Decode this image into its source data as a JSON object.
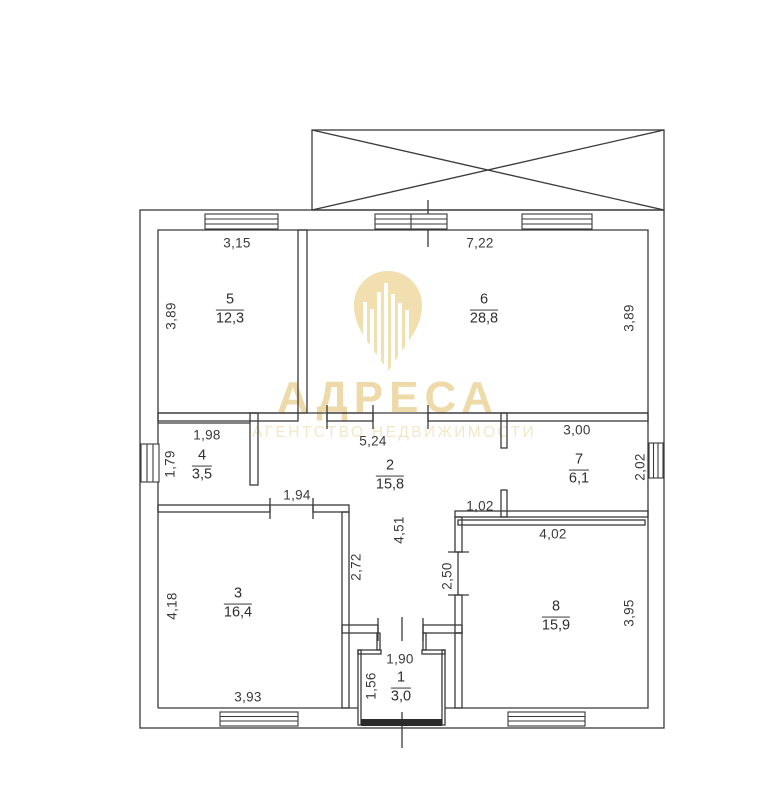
{
  "watermark": {
    "brand": "АДРЕСА",
    "subtitle": "АГЕНТСТВО НЕДВИЖИМОСТИ",
    "logo_color": "#f2dfb0",
    "brand_color": "#eedaa8",
    "subtitle_color": "#f3e7c7"
  },
  "plan": {
    "line_color": "#3a3a3a",
    "entrance_door_color": "#2b2b2b",
    "rooms": [
      {
        "id": "1",
        "area": "3,0",
        "dims": {
          "top": "1,90",
          "left": "1,56"
        }
      },
      {
        "id": "2",
        "area": "15,8",
        "dims": {
          "top": "5,24",
          "height": "4,51",
          "left_bottom": "1,94",
          "lower_left": "2,72",
          "lower_right": "2,50",
          "notch": "1,02"
        }
      },
      {
        "id": "3",
        "area": "16,4",
        "dims": {
          "left": "4,18",
          "bottom": "3,93"
        }
      },
      {
        "id": "4",
        "area": "3,5",
        "dims": {
          "top": "1,98",
          "left": "1,79"
        }
      },
      {
        "id": "5",
        "area": "12,3",
        "dims": {
          "top": "3,15",
          "left": "3,89"
        }
      },
      {
        "id": "6",
        "area": "28,8",
        "dims": {
          "top": "7,22",
          "right": "3,89"
        }
      },
      {
        "id": "7",
        "area": "6,1",
        "dims": {
          "top": "3,00",
          "right": "2,02"
        }
      },
      {
        "id": "8",
        "area": "15,9",
        "dims": {
          "top": "4,02",
          "right": "3,95"
        }
      }
    ]
  }
}
